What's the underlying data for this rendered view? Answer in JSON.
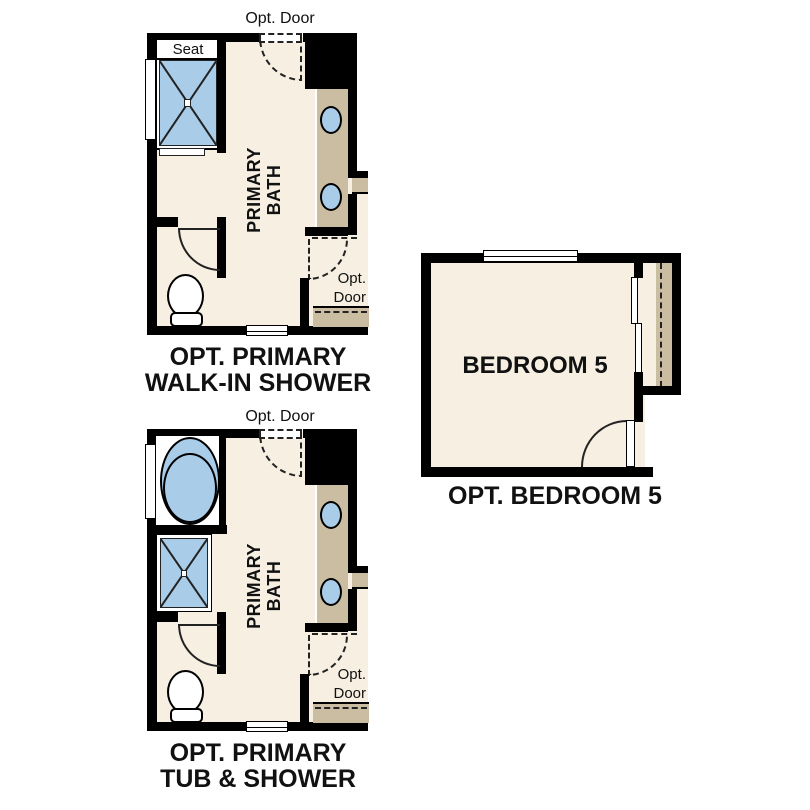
{
  "colors": {
    "background": "#ffffff",
    "wall": "#000000",
    "floor": "#f6efe2",
    "counter": "#cbbda2",
    "fixture": "#a9cce8",
    "text": "#111111"
  },
  "plans": {
    "walk_in_shower": {
      "opt_door_top": "Opt. Door",
      "seat_label": "Seat",
      "room_line1": "PRIMARY",
      "room_line2": "BATH",
      "side_opt": "Opt.",
      "side_door": "Door",
      "caption_line1": "OPT. PRIMARY",
      "caption_line2": "WALK-IN SHOWER"
    },
    "tub_shower": {
      "opt_door_top": "Opt. Door",
      "room_line1": "PRIMARY",
      "room_line2": "BATH",
      "side_opt": "Opt.",
      "side_door": "Door",
      "caption_line1": "OPT. PRIMARY",
      "caption_line2": "TUB & SHOWER"
    },
    "bedroom5": {
      "room_name": "BEDROOM 5",
      "caption": "OPT. BEDROOM 5"
    }
  }
}
